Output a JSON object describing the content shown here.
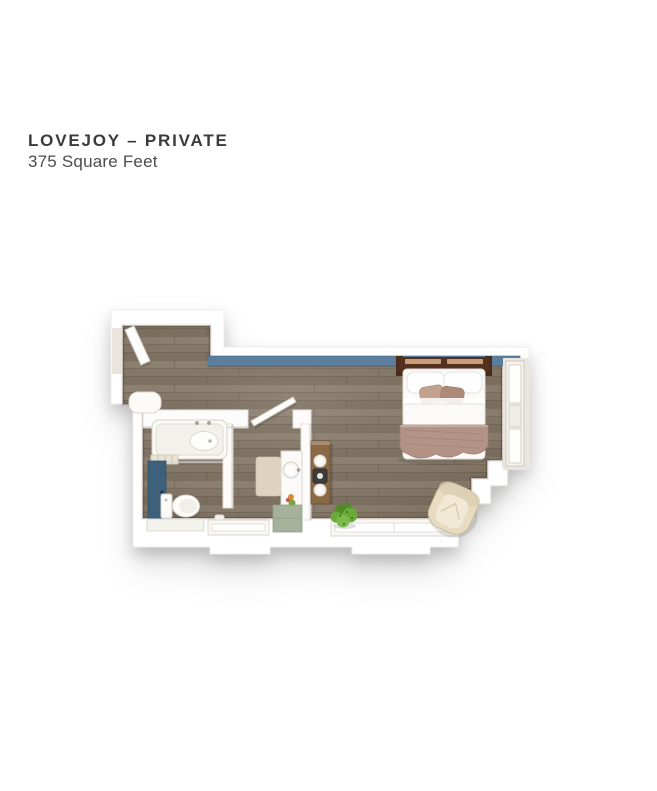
{
  "header": {
    "title": "LOVEJOY – PRIVATE",
    "subtitle": "375 Square Feet"
  },
  "floorplan": {
    "label": "lovejoy-private-floor-plan",
    "rooms": [
      "entry",
      "bathroom",
      "vanity-nook",
      "main-living-sleeping-area"
    ],
    "furniture": [
      "entry-door",
      "bathtub",
      "toilet",
      "bathroom-door",
      "vanity-sink",
      "bath-mat",
      "sage-cabinet",
      "wood-console",
      "coffee-maker",
      "plant",
      "bed",
      "armchair",
      "windows",
      "steps"
    ],
    "colors": {
      "floor": "#857868",
      "accent_blue": "#5b7e9e",
      "door_blue": "#3d617a",
      "headboard": "#54311f",
      "headboard_slat": "#c79e79",
      "blanket": "#b39385",
      "pillow_accent": "#c2a18e",
      "pillow_accent_2": "#ad8a77",
      "island_wood": "#8c6945",
      "plant_green": "#69aa3a",
      "plant_green_dark": "#4f8c28",
      "plant_green_light": "#7cbb4b",
      "chair_cream": "#e7dcc2",
      "chair_seat": "#f1e9d5",
      "cabinet_sage": "#a6b19c",
      "mat_beige": "#ddd3bf",
      "wall_white": "#ffffff"
    }
  }
}
